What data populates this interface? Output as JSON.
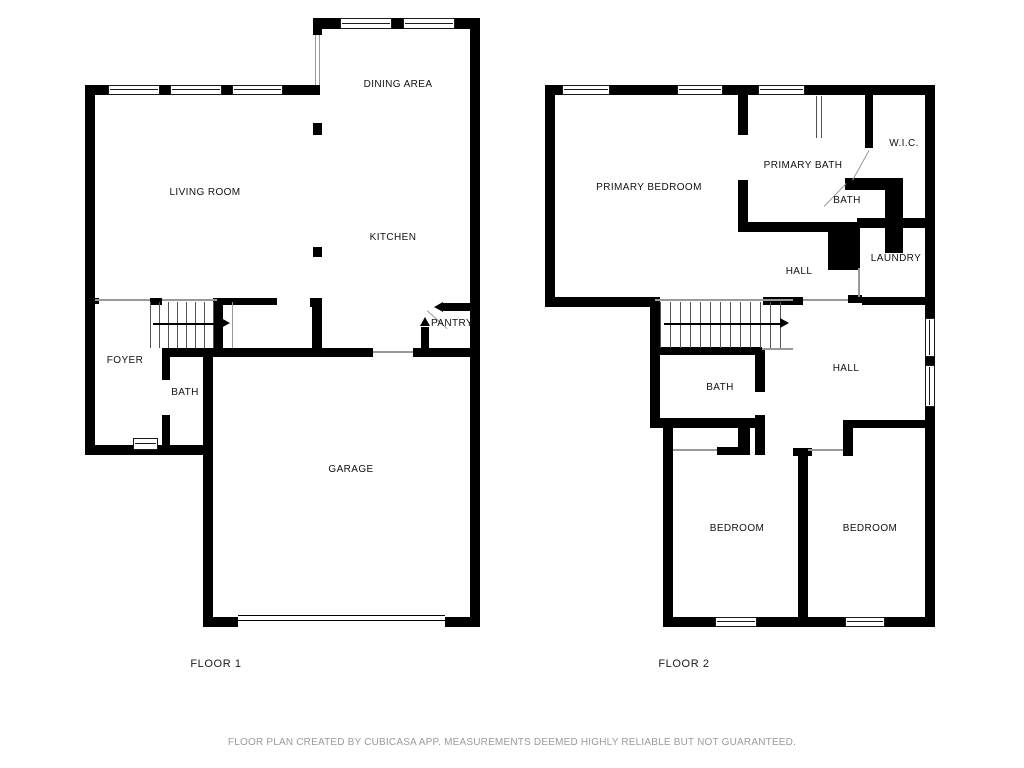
{
  "floor1": {
    "name": "FLOOR 1",
    "rooms": {
      "living_room": "LIVING ROOM",
      "dining_area": "DINING AREA",
      "kitchen": "KITCHEN",
      "pantry": "PANTRY",
      "foyer": "FOYER",
      "bath": "BATH",
      "garage": "GARAGE"
    }
  },
  "floor2": {
    "name": "FLOOR 2",
    "rooms": {
      "primary_bedroom": "PRIMARY BEDROOM",
      "primary_bath": "PRIMARY BATH",
      "wic": "W.I.C.",
      "bath_upper": "BATH",
      "laundry": "LAUNDRY",
      "hall_upper": "HALL",
      "hall_lower": "HALL",
      "bath_lower": "BATH",
      "bedroom_left": "BEDROOM",
      "bedroom_right": "BEDROOM"
    }
  },
  "footer": {
    "disclaimer": "FLOOR PLAN CREATED BY CUBICASA APP. MEASUREMENTS DEEMED HIGHLY RELIABLE BUT NOT GUARANTEED."
  },
  "colors": {
    "wall": "#000000",
    "text": "#111111",
    "muted_text": "#9b9b9b",
    "background": "#ffffff"
  }
}
